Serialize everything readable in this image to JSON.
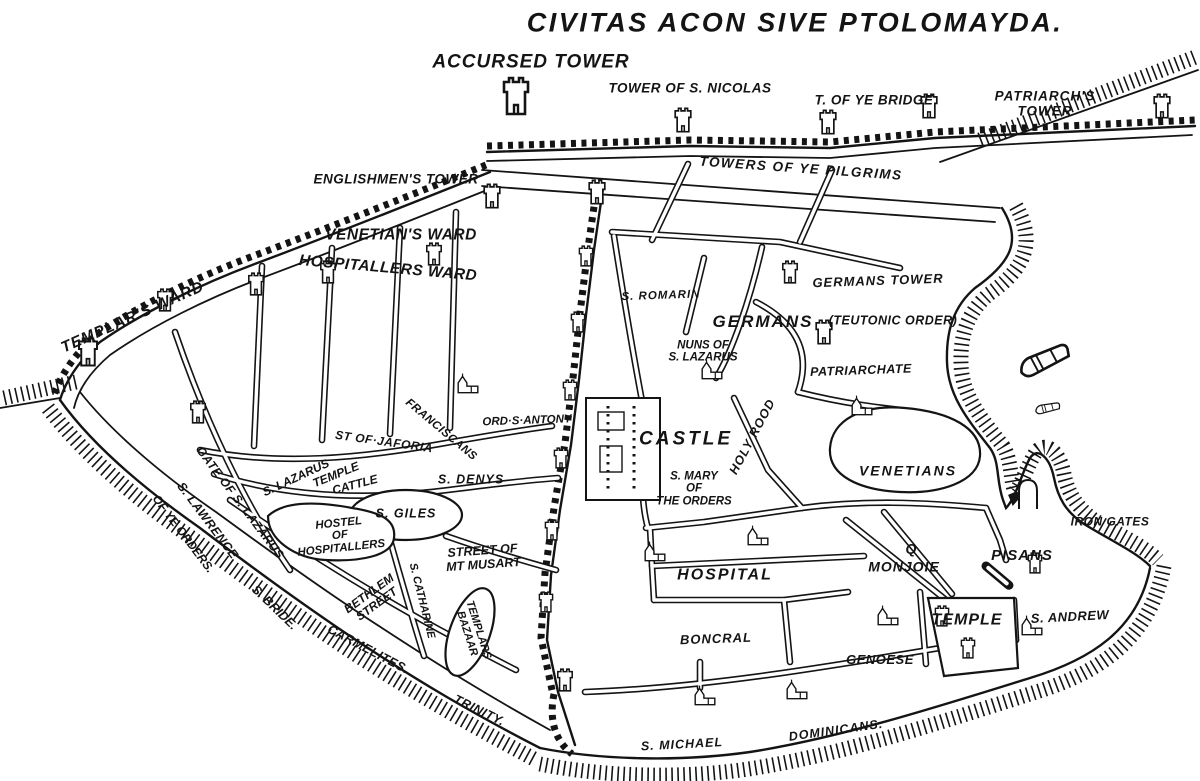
{
  "title": "CIVITAS ACON SIVE PTOLOMAYDA.",
  "colors": {
    "ink": "#141414",
    "paper": "#ffffff"
  },
  "icon_types": [
    "castle-tower-icon",
    "church-icon",
    "galley-ship-icon",
    "gate-arch-icon",
    "cannon-icon"
  ],
  "labels": [
    {
      "t": "ACCURSED TOWER",
      "x": 531,
      "y": 63,
      "s": 19,
      "sp": 1
    },
    {
      "t": "TOWER OF S. NICOLAS",
      "x": 690,
      "y": 89,
      "s": 13.5,
      "sp": 0.5
    },
    {
      "t": "T. OF YE BRIDGE",
      "x": 874,
      "y": 101,
      "s": 13.5,
      "sp": 0.5
    },
    {
      "t": "PATRIARCH'S TOWER",
      "x": 1045,
      "y": 104,
      "s": 13.5,
      "sp": 1
    },
    {
      "t": "ENGLISHMEN'S TOWER",
      "x": 396,
      "y": 180,
      "s": 13.5,
      "sp": 0.5
    },
    {
      "t": "TOWERS OF YE PILGRIMS",
      "x": 801,
      "y": 169,
      "r": 4,
      "s": 13.5,
      "sp": 1.5
    },
    {
      "t": "VENETIAN'S WARD",
      "x": 401,
      "y": 236,
      "s": 15.5,
      "sp": 0.5
    },
    {
      "t": "HOSPITALLERS WARD",
      "x": 388,
      "y": 269,
      "r": 5,
      "s": 15.5,
      "sp": 0.5
    },
    {
      "t": "TEMPLAR'S WARD",
      "x": 133,
      "y": 318,
      "r": -24,
      "s": 15.5,
      "sp": 1
    },
    {
      "t": "S. ROMARIN",
      "x": 661,
      "y": 296,
      "r": -2,
      "s": 11.5,
      "sp": 1
    },
    {
      "t": "GERMANS TOWER",
      "x": 878,
      "y": 281,
      "r": -2,
      "s": 13,
      "sp": 1
    },
    {
      "t": "GERMANS",
      "x": 763,
      "y": 322,
      "s": 17,
      "sp": 2
    },
    {
      "t": "(TEUTONIC ORDER)",
      "x": 893,
      "y": 321,
      "s": 12.5,
      "sp": 0.5
    },
    {
      "t": "NUNS OF\nS. LAZARUS",
      "x": 703,
      "y": 352,
      "s": 11.5
    },
    {
      "t": "PATRIARCHATE",
      "x": 861,
      "y": 371,
      "r": -2,
      "s": 12.5,
      "sp": 0.5
    },
    {
      "t": "ORD·S·ANTONY",
      "x": 527,
      "y": 421,
      "r": -2,
      "s": 11.5
    },
    {
      "t": "CASTLE",
      "x": 686,
      "y": 440,
      "s": 19,
      "sp": 3
    },
    {
      "t": "HOLY ROOD",
      "x": 753,
      "y": 437,
      "r": -62,
      "s": 12.5,
      "sp": 1
    },
    {
      "t": "S. MARY\nOF\nTHE ORDERS",
      "x": 694,
      "y": 489,
      "s": 11.5
    },
    {
      "t": "VENETIANS",
      "x": 908,
      "y": 471,
      "s": 14,
      "sp": 2
    },
    {
      "t": "IRON GATES",
      "x": 1110,
      "y": 522,
      "s": 12,
      "sp": 0.5
    },
    {
      "t": "GATE OF S. LAZARUS",
      "x": 240,
      "y": 503,
      "r": 53,
      "s": 12,
      "sp": 0.5
    },
    {
      "t": "S. LAZARUS",
      "x": 296,
      "y": 478,
      "r": -25,
      "s": 12
    },
    {
      "t": "TEMPLE",
      "x": 336,
      "y": 475,
      "r": -22,
      "s": 12
    },
    {
      "t": "CATTLE",
      "x": 355,
      "y": 485,
      "r": -15,
      "s": 12
    },
    {
      "t": "ST OF·JAFORIA",
      "x": 384,
      "y": 442,
      "r": 8,
      "s": 12,
      "sp": 0.5
    },
    {
      "t": "FRANCISCANS",
      "x": 441,
      "y": 430,
      "r": 40,
      "s": 11.5,
      "sp": 0.5
    },
    {
      "t": "S. DENYS",
      "x": 471,
      "y": 480,
      "s": 12.5,
      "sp": 1
    },
    {
      "t": "S. GILES",
      "x": 406,
      "y": 514,
      "s": 12.5,
      "sp": 1
    },
    {
      "t": "HOSTEL\nOF\nHOSPITALLERS",
      "x": 340,
      "y": 536,
      "r": -6,
      "s": 11.5
    },
    {
      "t": "STREET OF\nMT MUSART",
      "x": 483,
      "y": 558,
      "r": -4,
      "s": 12.5
    },
    {
      "t": "BETHLEM\nSTREET",
      "x": 373,
      "y": 599,
      "r": -36,
      "s": 12
    },
    {
      "t": "S. CATHARINE",
      "x": 421,
      "y": 601,
      "r": 76,
      "s": 11
    },
    {
      "t": "TEMPLARS\nBAZAAR",
      "x": 472,
      "y": 632,
      "r": 72,
      "s": 11
    },
    {
      "t": "S. LAWRENCE",
      "x": 207,
      "y": 521,
      "r": 53,
      "s": 12.5,
      "sp": 0.5
    },
    {
      "t": "OF YE ORDERS.",
      "x": 183,
      "y": 534,
      "r": 53,
      "s": 12
    },
    {
      "t": "S. BRIDE.",
      "x": 274,
      "y": 608,
      "r": 44,
      "s": 12.5
    },
    {
      "t": "CARMELITES.",
      "x": 368,
      "y": 650,
      "r": 28,
      "s": 12.5,
      "sp": 0.5
    },
    {
      "t": "TRINITY.",
      "x": 479,
      "y": 711,
      "r": 26,
      "s": 12.5,
      "sp": 0.5
    },
    {
      "t": "HOSPITAL",
      "x": 725,
      "y": 575,
      "s": 16,
      "sp": 2
    },
    {
      "t": "Q",
      "x": 911,
      "y": 549,
      "s": 14
    },
    {
      "t": "MONJOIE",
      "x": 904,
      "y": 567,
      "s": 14,
      "sp": 1
    },
    {
      "t": "PISANS",
      "x": 1022,
      "y": 556,
      "s": 15,
      "sp": 1
    },
    {
      "t": "TEMPLE",
      "x": 967,
      "y": 620,
      "s": 16,
      "sp": 1
    },
    {
      "t": "S. ANDREW",
      "x": 1070,
      "y": 617,
      "r": -3,
      "s": 13,
      "sp": 0.5
    },
    {
      "t": "GENOESE",
      "x": 880,
      "y": 660,
      "s": 13,
      "sp": 0.5
    },
    {
      "t": "BONCRAL",
      "x": 716,
      "y": 639,
      "r": -2,
      "s": 13,
      "sp": 1
    },
    {
      "t": "S. MICHAEL",
      "x": 682,
      "y": 745,
      "r": -3,
      "s": 12.5,
      "sp": 1
    },
    {
      "t": "DOMINICANS.",
      "x": 836,
      "y": 731,
      "r": -8,
      "s": 12.5,
      "sp": 1
    }
  ],
  "features": {
    "towers": [
      [
        516,
        96,
        2.0
      ],
      [
        683,
        120,
        1.3
      ],
      [
        828,
        122,
        1.3
      ],
      [
        929,
        106,
        1.3
      ],
      [
        1162,
        106,
        1.3
      ],
      [
        88,
        352,
        1.5
      ],
      [
        165,
        300,
        1.2
      ],
      [
        256,
        284,
        1.2
      ],
      [
        328,
        272,
        1.2
      ],
      [
        434,
        254,
        1.2
      ],
      [
        198,
        412,
        1.2
      ],
      [
        492,
        196,
        1.3
      ],
      [
        597,
        192,
        1.3
      ],
      [
        586,
        256,
        1.1
      ],
      [
        578,
        322,
        1.1
      ],
      [
        570,
        390,
        1.1
      ],
      [
        561,
        458,
        1.1
      ],
      [
        552,
        530,
        1.1
      ],
      [
        546,
        602,
        1.1
      ],
      [
        565,
        680,
        1.2
      ],
      [
        790,
        272,
        1.2
      ],
      [
        824,
        332,
        1.3
      ],
      [
        1035,
        563,
        1.1
      ],
      [
        942,
        616,
        1.1
      ],
      [
        968,
        648,
        1.1
      ]
    ],
    "churches": [
      [
        712,
        370
      ],
      [
        862,
        406
      ],
      [
        655,
        552
      ],
      [
        758,
        536
      ],
      [
        888,
        616
      ],
      [
        1032,
        626
      ],
      [
        705,
        696
      ],
      [
        797,
        690
      ],
      [
        468,
        384
      ]
    ],
    "ships": [
      [
        1045,
        360,
        1.9,
        -28
      ],
      [
        1048,
        408,
        0.9,
        -15
      ]
    ],
    "arches": [
      [
        1028,
        494
      ]
    ],
    "cannons": [
      [
        986,
        566,
        40
      ]
    ]
  }
}
